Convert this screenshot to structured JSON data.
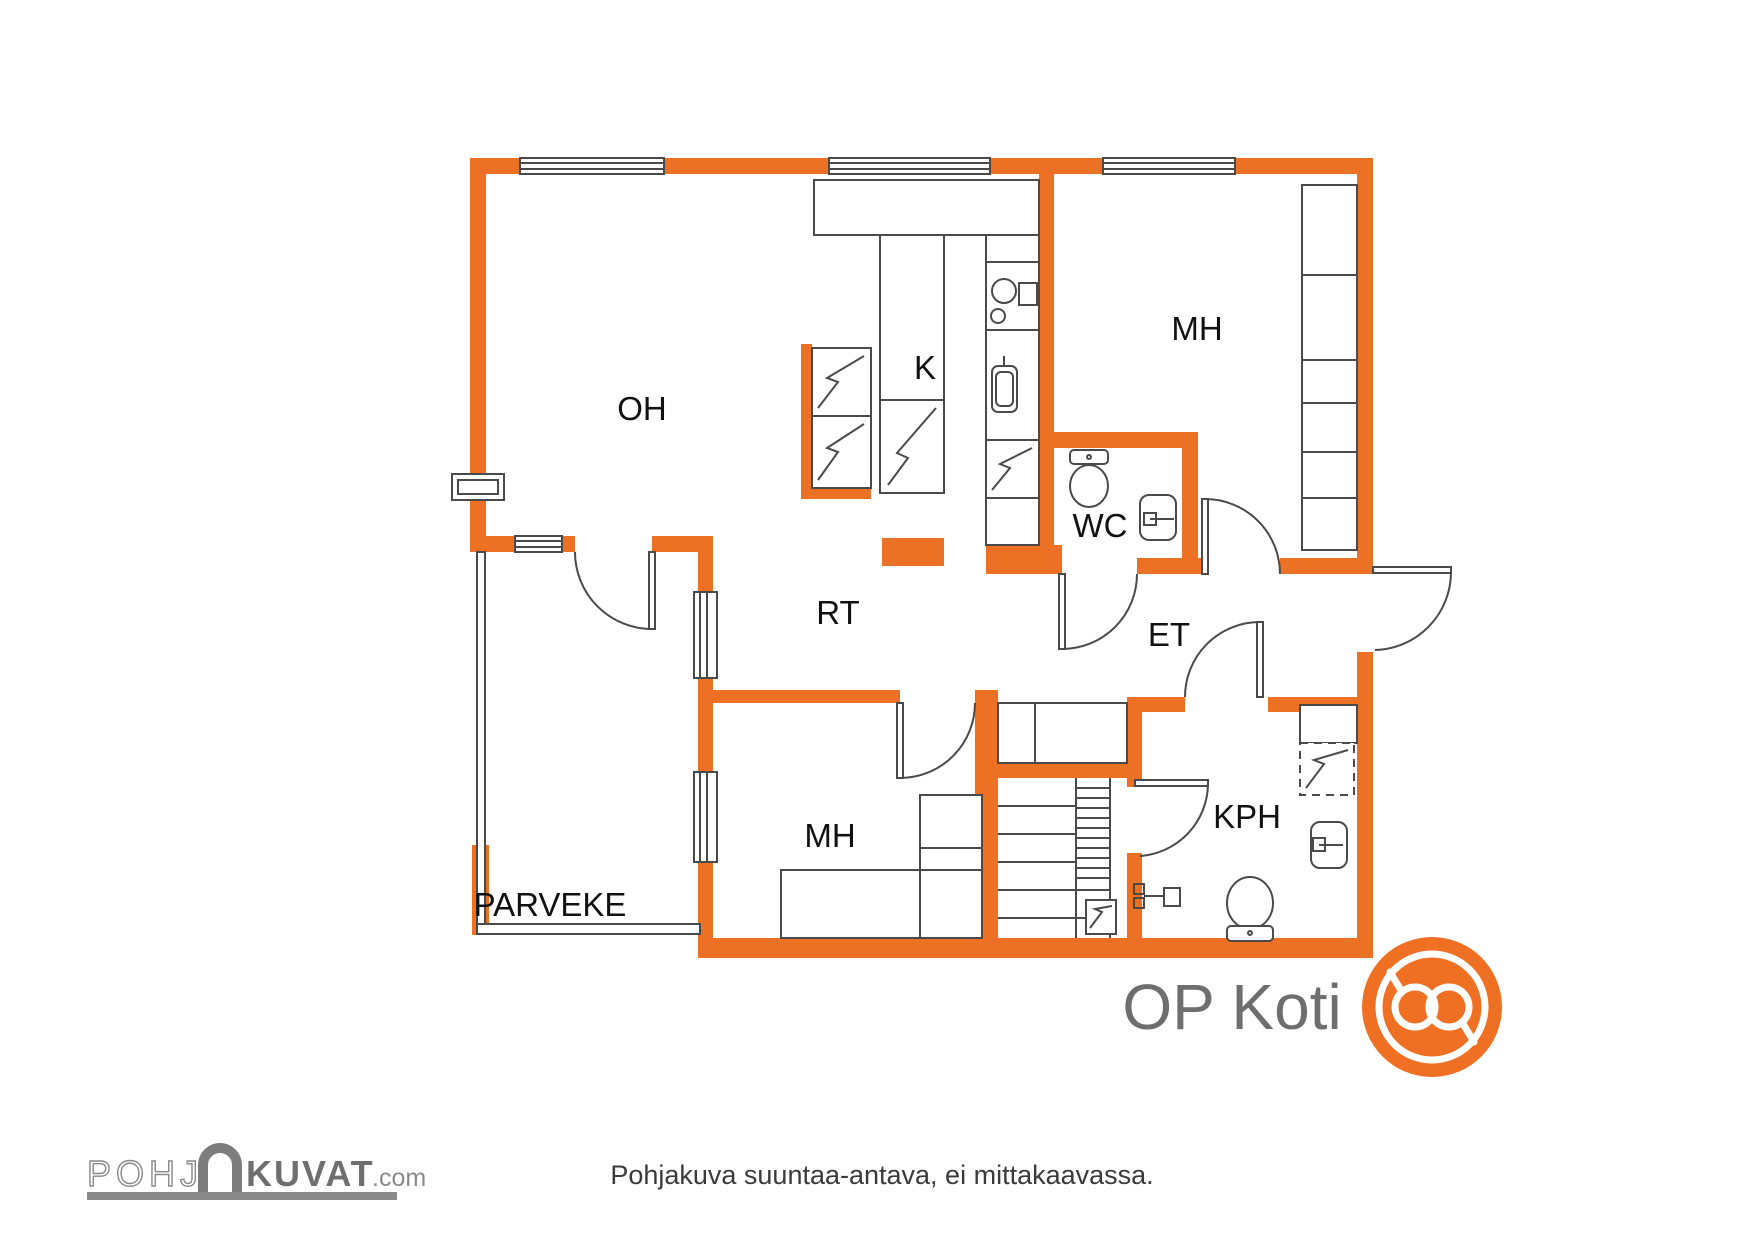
{
  "plan": {
    "colors": {
      "wall": "#ED7125",
      "line": "#4A4A4A",
      "label": "#111111"
    },
    "rooms": {
      "oh": {
        "label": "OH"
      },
      "k": {
        "label": "K"
      },
      "mh_top": {
        "label": "MH"
      },
      "wc": {
        "label": "WC"
      },
      "rt": {
        "label": "RT"
      },
      "et": {
        "label": "ET"
      },
      "mh_bottom": {
        "label": "MH"
      },
      "kph": {
        "label": "KPH"
      },
      "parveke": {
        "label": "PARVEKE"
      }
    },
    "fixtures": [
      "kitchen-counter",
      "stove",
      "kitchen-sink",
      "tall-cabinet",
      "refrigerator",
      "fireplace",
      "toilet",
      "washbasin",
      "wardrobe",
      "closet",
      "staircase",
      "shower-mixer",
      "appliance-reservation",
      "balcony-railing",
      "windows",
      "doors"
    ]
  },
  "footer": {
    "disclaimer": "Pohjakuva suuntaa-antava, ei mittakaavassa."
  },
  "branding": {
    "op_koti": {
      "text": "OP Koti",
      "text_color": "#6E6E6E",
      "logo_color": "#EF7022"
    },
    "pohjakuvat": {
      "part1": "POHJ",
      "part2": "KUVAT",
      "suffix": ".com",
      "color": "#8A8A8A"
    }
  }
}
